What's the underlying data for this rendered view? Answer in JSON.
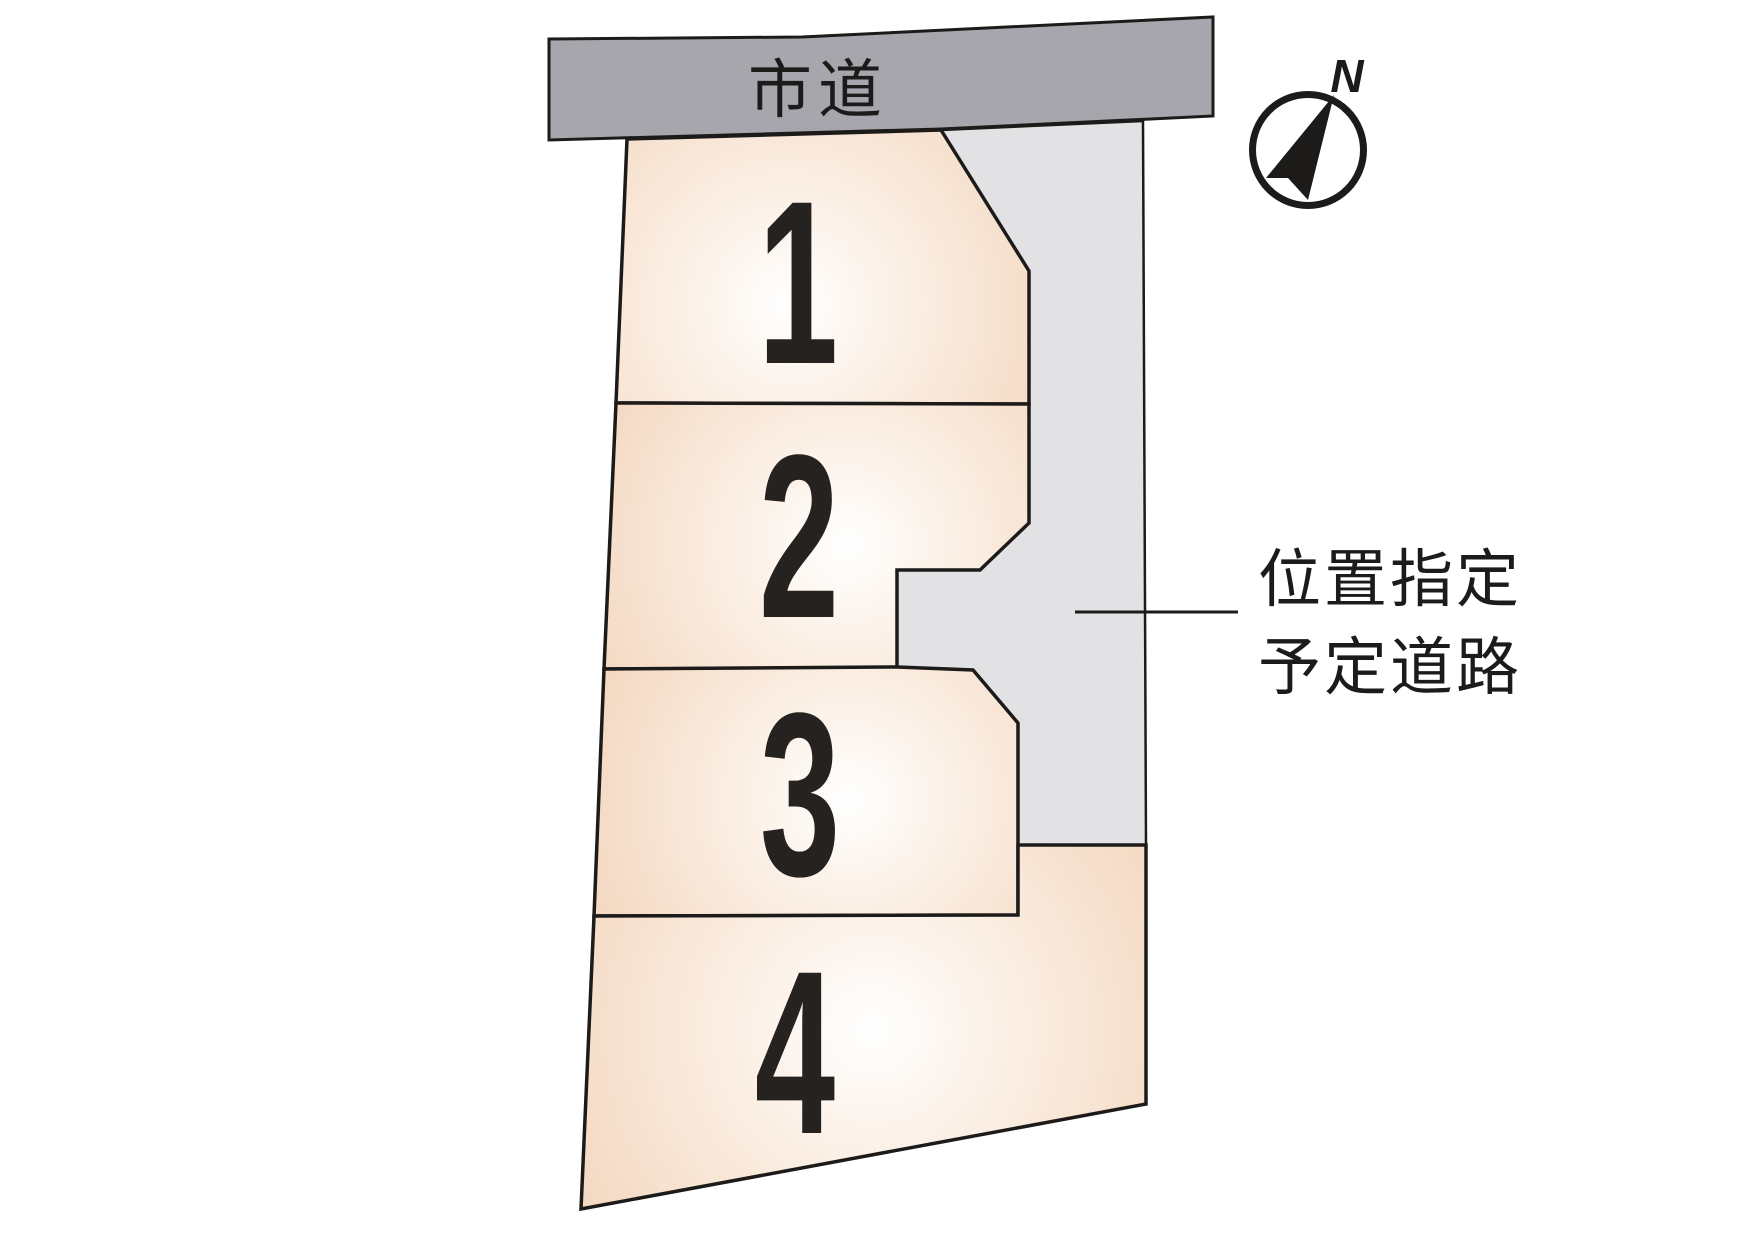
{
  "figure": {
    "title": "lot-subdivision-plan",
    "city_road": {
      "label": "市道"
    },
    "planned_road": {
      "label_line1": "位置指定",
      "label_line2": "予定道路"
    },
    "lots": [
      {
        "number": "1"
      },
      {
        "number": "2"
      },
      {
        "number": "3"
      },
      {
        "number": "4"
      }
    ],
    "compass": {
      "north_label": "N"
    },
    "colors": {
      "city_road_fill": "#a8a6ad",
      "planned_road_fill": "#e2e2e5",
      "lot_fill_edge": "#f1d1b6",
      "lot_fill_center": "#ffffff",
      "outline": "#1d1b1a"
    }
  }
}
